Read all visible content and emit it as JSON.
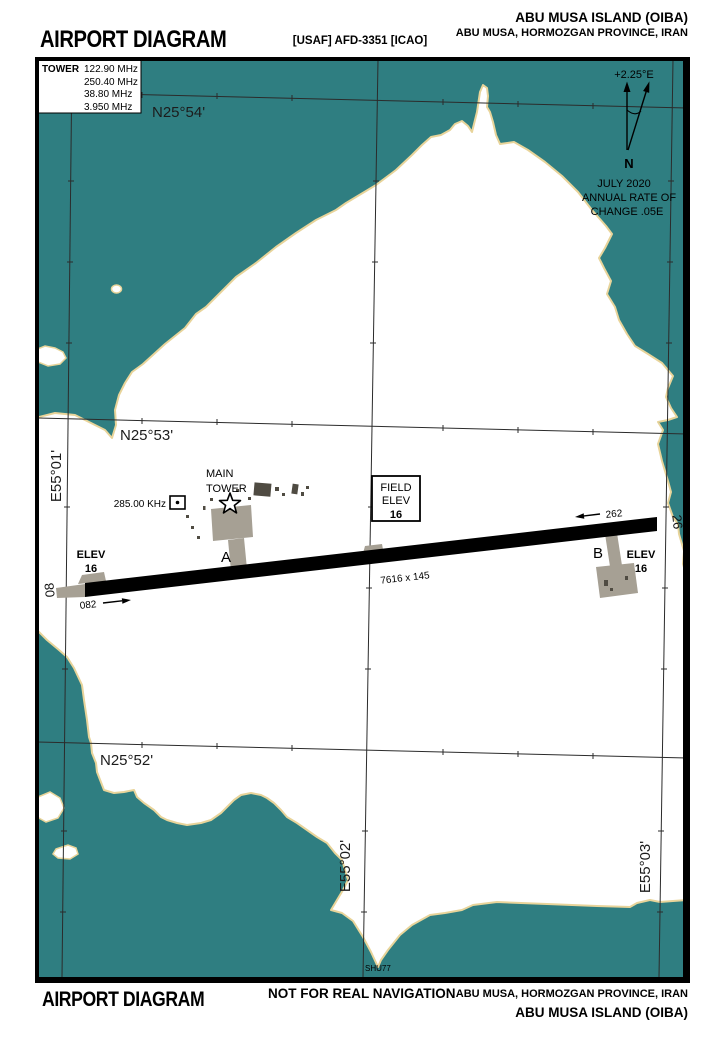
{
  "header": {
    "title": "AIRPORT DIAGRAM",
    "doc_ref": "[USAF] AFD-3351 [ICAO]",
    "airport_name": "ABU MUSA ISLAND (OIBA)",
    "location": "ABU MUSA, HORMOZGAN PROVINCE, IRAN"
  },
  "tower_box": {
    "label": "TOWER",
    "frequencies": [
      "122.90 MHz",
      "250.40 MHz",
      "38.80 MHz",
      "3.950 MHz"
    ]
  },
  "graticule": {
    "lat_54": "N25°54'",
    "lat_53": "N25°53'",
    "lat_52": "N25°52'",
    "lon_01": "E55°01'",
    "lon_02": "E55°02'",
    "lon_03": "E55°03'"
  },
  "compass": {
    "declination": "+2.25°E",
    "north": "N",
    "date": "JULY 2020",
    "rate_line1": "ANNUAL RATE OF",
    "rate_line2": "CHANGE .05E"
  },
  "runway": {
    "dimensions": "7616 x 145",
    "west_number": "08",
    "east_number": "26",
    "west_heading": "082",
    "east_heading": "262",
    "west_elev_label": "ELEV",
    "west_elev_value": "16",
    "east_elev_label": "ELEV",
    "east_elev_value": "16"
  },
  "field_elev": {
    "line1": "FIELD",
    "line2": "ELEV",
    "value": "16"
  },
  "taxiways": {
    "a": "A",
    "b": "B"
  },
  "ndb": {
    "frequency": "285.00 KHz"
  },
  "main_tower": {
    "line1": "MAIN",
    "line2": "TOWER"
  },
  "chart_code": "SHU77",
  "footer": {
    "title": "AIRPORT DIAGRAM",
    "warning": "NOT FOR REAL NAVIGATION",
    "location": "ABU MUSA, HORMOZGAN PROVINCE, IRAN",
    "airport_name": "ABU MUSA ISLAND (OIBA)"
  },
  "colors": {
    "sea": "#2F7E81",
    "shoreline": "#E8D49A",
    "pavement": "#A6A094",
    "building": "#4F4B42",
    "runway": "#000000"
  }
}
